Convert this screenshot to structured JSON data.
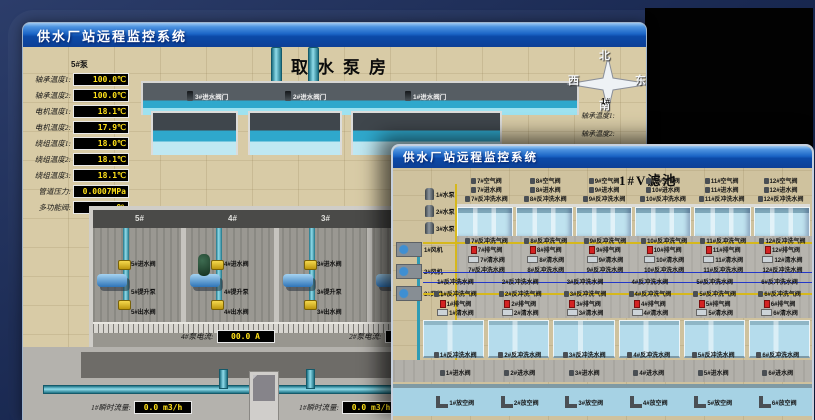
{
  "colors": {
    "titlebar_top": "#9cc8f2",
    "titlebar_bottom": "#0d4096",
    "value_text": "#ffe11a",
    "pipe_cyan": "#2fa8cc",
    "valve_yellow": "#e0c020"
  },
  "back_window": {
    "title": "供水厂站远程监控系统",
    "scene_title": "取水泵房",
    "panel": {
      "header": "5#泵",
      "rows": [
        {
          "label": "轴承温度1:",
          "value": "100.0℃"
        },
        {
          "label": "轴承温度2:",
          "value": "100.0℃"
        },
        {
          "label": "电机温度1:",
          "value": "18.1℃"
        },
        {
          "label": "电机温度2:",
          "value": "17.9℃"
        },
        {
          "label": "绕组温度1:",
          "value": "18.0℃"
        },
        {
          "label": "绕组温度2:",
          "value": "18.1℃"
        },
        {
          "label": "绕组温度3:",
          "value": "18.1℃"
        },
        {
          "label": "管道压力:",
          "value": "0.0007MPa"
        },
        {
          "label": "多功能阀:",
          "value": "0%"
        }
      ]
    },
    "intake_valves": [
      "3#进水阀门",
      "2#进水阀门",
      "1#进水阀门"
    ],
    "bays": [
      {
        "no": "5#",
        "inlet": "5#进水阀",
        "pump": "5#提升泵",
        "outlet": "5#出水阀"
      },
      {
        "no": "4#",
        "inlet": "4#进水阀",
        "pump": "4#提升泵",
        "outlet": "4#出水阀"
      },
      {
        "no": "3#",
        "inlet": "3#进水阀",
        "pump": "3#提升泵",
        "outlet": "3#出水阀"
      },
      {
        "no": "2#"
      }
    ],
    "currents": [
      {
        "label": "4#泵电流:",
        "value": "00.0 A"
      },
      {
        "label": "2#泵电流:",
        "value": ""
      }
    ],
    "flows": [
      {
        "label": "1#瞬时流量:",
        "value": "0.0 m3/h"
      },
      {
        "label": "1#瞬时流量:",
        "value": "0.0 m3/h"
      }
    ],
    "compass": {
      "north": "北",
      "west": "西",
      "south": "南",
      "east": "东"
    },
    "side_panel": {
      "header": "1#",
      "rows": [
        "轴承温度1:",
        "轴承温度2:"
      ]
    }
  },
  "front_window": {
    "title": "供水厂站远程监控系统",
    "scene_title": "1#V滤池",
    "pumps": [
      "1#水泵",
      "2#水泵",
      "3#水泵"
    ],
    "blowers": [
      "1#风机",
      "2#风机",
      "3#风机"
    ],
    "top_cells": [
      {
        "air": "7#空气阀",
        "inlet": "7#进水阀",
        "bw": "7#反冲洗水阀",
        "gas": "7#反冲洗气阀",
        "vent": "7#排气阀",
        "clean": "7#清水阀"
      },
      {
        "air": "8#空气阀",
        "inlet": "8#进水阀",
        "bw": "8#反冲洗水阀",
        "gas": "8#反冲洗气阀",
        "vent": "8#排气阀",
        "clean": "8#清水阀"
      },
      {
        "air": "9#空气阀",
        "inlet": "9#进水阀",
        "bw": "9#反冲洗水阀",
        "gas": "9#反冲洗气阀",
        "vent": "9#排气阀",
        "clean": "9#清水阀"
      },
      {
        "air": "10#空气阀",
        "inlet": "10#进水阀",
        "bw": "10#反冲洗水阀",
        "gas": "10#反冲洗气阀",
        "vent": "10#排气阀",
        "clean": "10#清水阀"
      },
      {
        "air": "11#空气阀",
        "inlet": "11#进水阀",
        "bw": "11#反冲洗水阀",
        "gas": "11#反冲洗气阀",
        "vent": "11#排气阀",
        "clean": "11#清水阀"
      },
      {
        "air": "12#空气阀",
        "inlet": "12#进水阀",
        "bw": "12#反冲洗水阀",
        "gas": "12#反冲洗气阀",
        "vent": "12#排气阀",
        "clean": "12#清水阀"
      }
    ],
    "bottom_cells": [
      {
        "bw": "1#反冲洗水阀",
        "gas": "1#反冲洗气阀",
        "vent": "1#排气阀",
        "clean": "1#清水阀",
        "inlet": "1#进水阀",
        "drain": "1#放空阀"
      },
      {
        "bw": "2#反冲洗水阀",
        "gas": "2#反冲洗气阀",
        "vent": "2#排气阀",
        "clean": "2#清水阀",
        "inlet": "2#进水阀",
        "drain": "2#放空阀"
      },
      {
        "bw": "3#反冲洗水阀",
        "gas": "3#反冲洗气阀",
        "vent": "3#排气阀",
        "clean": "3#清水阀",
        "inlet": "3#进水阀",
        "drain": "3#放空阀"
      },
      {
        "bw": "4#反冲洗水阀",
        "gas": "4#反冲洗气阀",
        "vent": "4#排气阀",
        "clean": "4#清水阀",
        "inlet": "4#进水阀",
        "drain": "4#放空阀"
      },
      {
        "bw": "5#反冲洗水阀",
        "gas": "5#反冲洗气阀",
        "vent": "5#排气阀",
        "clean": "5#清水阀",
        "inlet": "5#进水阀",
        "drain": "5#放空阀"
      },
      {
        "bw": "6#反冲洗水阀",
        "gas": "6#反冲洗气阀",
        "vent": "6#排气阀",
        "clean": "6#清水阀",
        "inlet": "6#进水阀",
        "drain": "6#放空阀"
      }
    ]
  }
}
